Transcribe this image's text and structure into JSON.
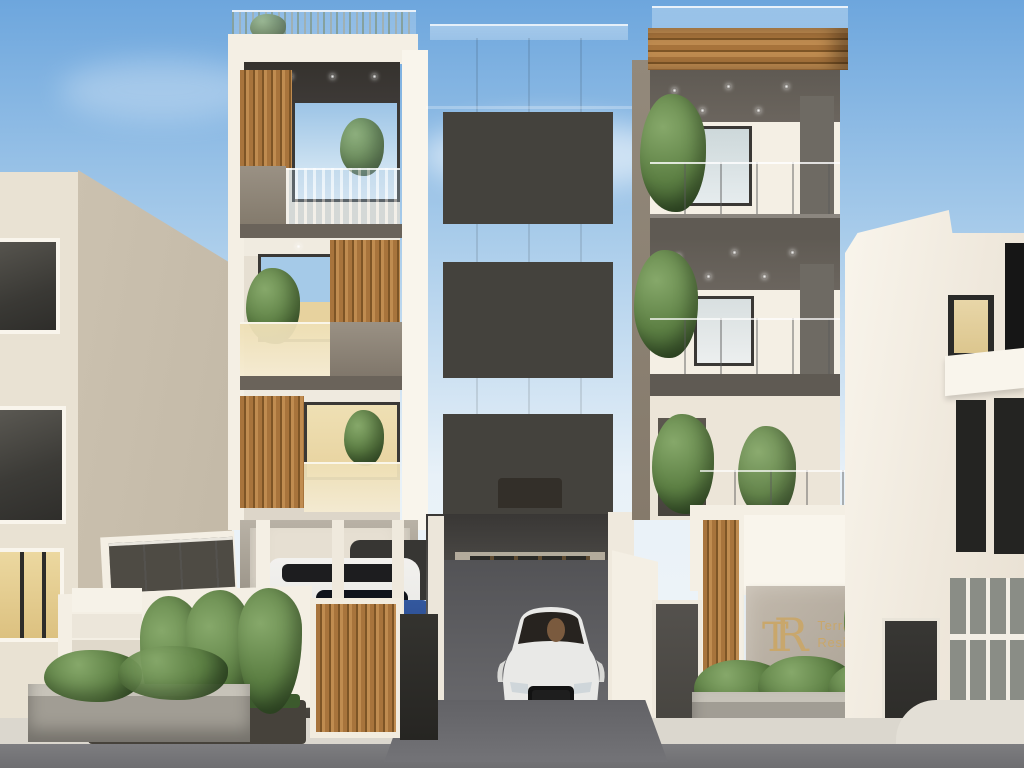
{
  "sign": {
    "mono_t": "T",
    "mono_r": "R",
    "line1": "Terrace",
    "line2": "Residence"
  },
  "colors": {
    "sky_top": "#6da6dd",
    "sky_mid": "#a7cbea",
    "sky_low": "#e8f1f8",
    "concrete": "#9d9080",
    "concrete_dark": "#857867",
    "concrete_light": "#b0a494",
    "cream": "#f4efe4",
    "cream_dim": "#e6dfd2",
    "beige": "#e9e2d3",
    "beige_shadow": "#cbc1af",
    "white_side": "#f9f5ec",
    "soffit_dark": "#3d3936",
    "soffit_grey": "#6b655e",
    "fascia_grey": "#5f5a53",
    "band_dark": "#6a635a",
    "wood": "#a8743c",
    "wood_dark": "#7e5526",
    "wood_light": "#c08c50",
    "interior_warm": "#e7d29e",
    "window_frame": "#44423d",
    "window_dark": "#2a2a27",
    "glass_dark": "#4e4b44",
    "asphalt": "#7d7d80",
    "drive_dark": "#535356",
    "sidewalk": "#dbd7ce",
    "stone": "#a19d94",
    "stone_top": "#c7c3b9",
    "soil": "#46423b",
    "green": "#5d8044",
    "green_dark": "#3c5a2d",
    "green_light": "#86a86a",
    "gold": "#c9a76b",
    "sign_stone1": "#c2b9ac",
    "sign_stone2": "#a89f92",
    "car_white": "#e9e9e6",
    "car_blue": "#2b4a8e",
    "car_dark": "#373633"
  }
}
